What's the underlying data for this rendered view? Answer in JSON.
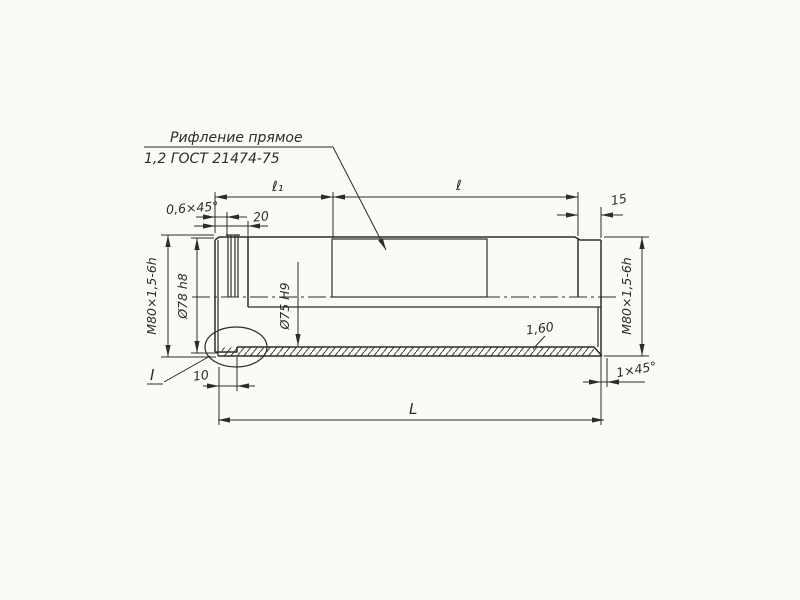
{
  "colors": {
    "paper": "#fbfaf7",
    "ink": "#2e2c28"
  },
  "note": {
    "line1": "Рифление прямое",
    "line2": "1,2 ГОСТ 21474-75"
  },
  "dims": {
    "l1": "ℓ₁",
    "l": "ℓ",
    "chamfer_left": "0,6×45°",
    "len20": "20",
    "len15": "15",
    "thread_left": "М80×1,5-6h",
    "d78": "Ø78 h8",
    "d75": "Ø75 Н9",
    "thread_right": "М80×1,5-6h",
    "wall": "1,60",
    "chamfer_right": "1×45°",
    "len10": "10",
    "total": "L",
    "detail": "I"
  }
}
